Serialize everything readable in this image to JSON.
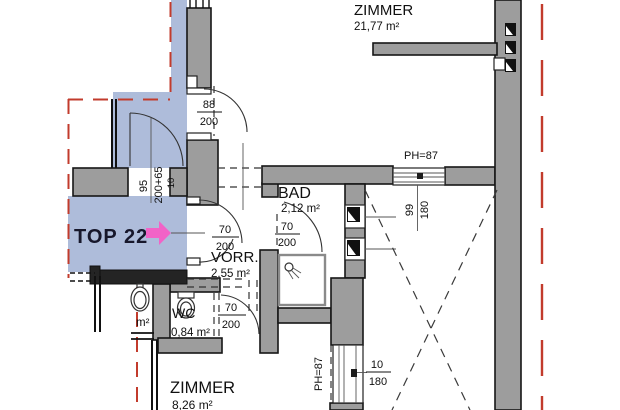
{
  "unit": {
    "label": "TOP 22"
  },
  "rooms": {
    "zimmer_top": {
      "name": "ZIMMER",
      "area": "21,77 m²"
    },
    "bad": {
      "name": "BAD",
      "area": "2,12 m²"
    },
    "vorraum": {
      "name": "VORR.",
      "area": "2,55 m²"
    },
    "wc": {
      "name": "WC",
      "area": "0,84 m²"
    },
    "zimmer_bottom": {
      "name": "ZIMMER",
      "area": "8,26 m²"
    },
    "cut_room": {
      "area_suffix": "m²"
    }
  },
  "openings": {
    "door_top": {
      "width": "88",
      "height": "200"
    },
    "door_entry": {
      "width": "70",
      "height": "200"
    },
    "door_bad": {
      "width": "70",
      "height": "200"
    },
    "door_wc": {
      "width": "70",
      "height": "200"
    },
    "door_landing": {
      "width": "95",
      "height": "200+65",
      "wall_thickness": "10"
    },
    "window_right": {
      "width": "99",
      "height": "180",
      "parapet": "PH=87"
    },
    "window_bottom": {
      "width": "10",
      "height": "180",
      "parapet": "PH=87"
    }
  },
  "colors": {
    "highlight_blue": "#aebcda",
    "boundary_red": "#c23b2c",
    "arrow_pink": "#f263c7",
    "wall_gray": "#9d9d9d"
  }
}
